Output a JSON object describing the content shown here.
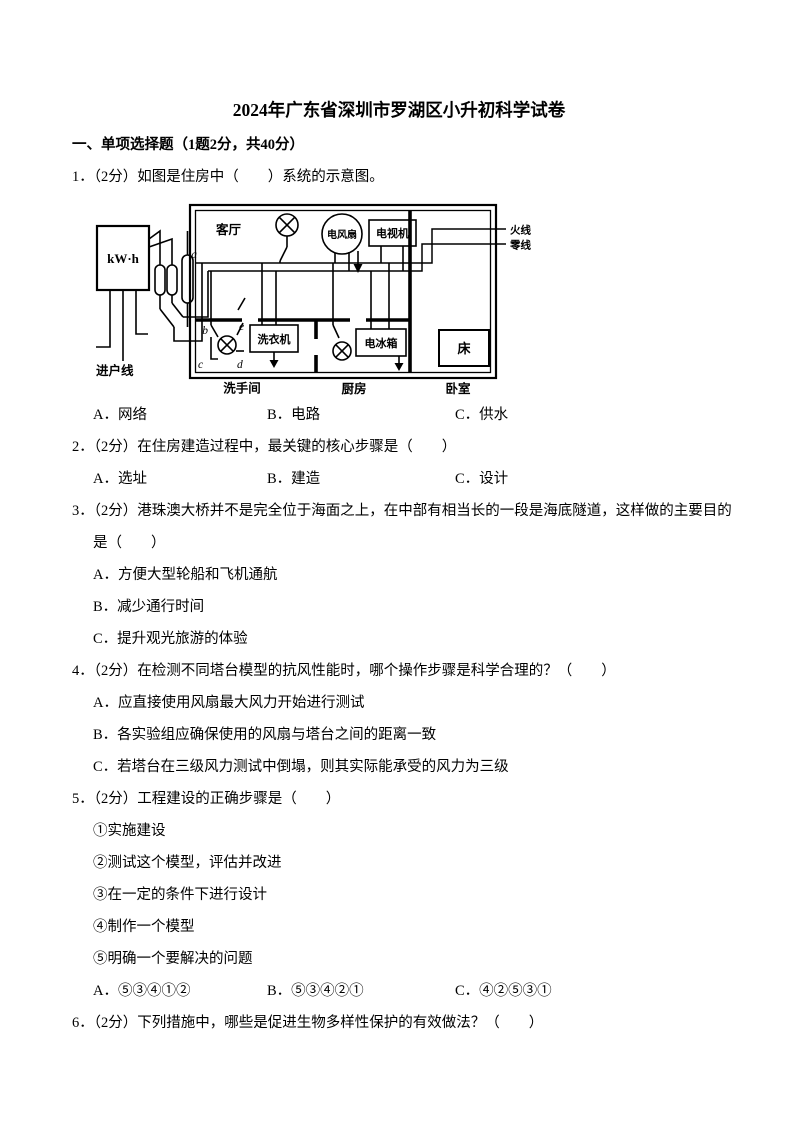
{
  "page": {
    "title": "2024年广东省深圳市罗湖区小升初科学试卷",
    "section_heading": "一、单项选择题（1题2分，共40分）"
  },
  "questions": {
    "q1": {
      "stem": "1．（2分）如图是住房中（　　）系统的示意图。",
      "options": {
        "a": "A．网络",
        "b": "B．电路",
        "c": "C．供水"
      }
    },
    "q2": {
      "stem": "2．（2分）在住房建造过程中，最关键的核心步骤是（　　）",
      "options": {
        "a": "A．选址",
        "b": "B．建造",
        "c": "C．设计"
      }
    },
    "q3": {
      "stem_line1": "3．（2分）港珠澳大桥并不是完全位于海面之上，在中部有相当长的一段是海底隧道，这样做的主要目的",
      "stem_line2": "是（　　）",
      "options": {
        "a": "A．方便大型轮船和飞机通航",
        "b": "B．减少通行时间",
        "c": "C．提升观光旅游的体验"
      }
    },
    "q4": {
      "stem": "4．（2分）在检测不同塔台模型的抗风性能时，哪个操作步骤是科学合理的？（　　）",
      "options": {
        "a": "A．应直接使用风扇最大风力开始进行测试",
        "b": "B．各实验组应确保使用的风扇与塔台之间的距离一致",
        "c": "C．若塔台在三级风力测试中倒塌，则其实际能承受的风力为三级"
      }
    },
    "q5": {
      "stem": "5．（2分）工程建设的正确步骤是（　　）",
      "items": [
        "①实施建设",
        "②测试这个模型，评估并改进",
        "③在一定的条件下进行设计",
        "④制作一个模型",
        "⑤明确一个要解决的问题"
      ],
      "options": {
        "a": "A．⑤③④①②",
        "b": "B．⑤③④②①",
        "c": "C．④②⑤③①"
      }
    },
    "q6": {
      "stem": "6．（2分）下列措施中，哪些是促进生物多样性保护的有效做法？（　　）"
    }
  },
  "diagram": {
    "meter_label": "kW·h",
    "incoming_line_label": "进户线",
    "living_room_label": "客厅",
    "fan_label": "电风扇",
    "tv_label": "电视机",
    "washer_label": "洗衣机",
    "fridge_label": "电冰箱",
    "bed_label": "床",
    "bathroom_label": "洗手间",
    "kitchen_label": "厨房",
    "bedroom_label": "卧室",
    "live_wire_label": "火线",
    "neutral_wire_label": "零线",
    "point_a": "a",
    "point_b": "b",
    "point_c": "c",
    "point_d": "d",
    "point_e": "e"
  }
}
